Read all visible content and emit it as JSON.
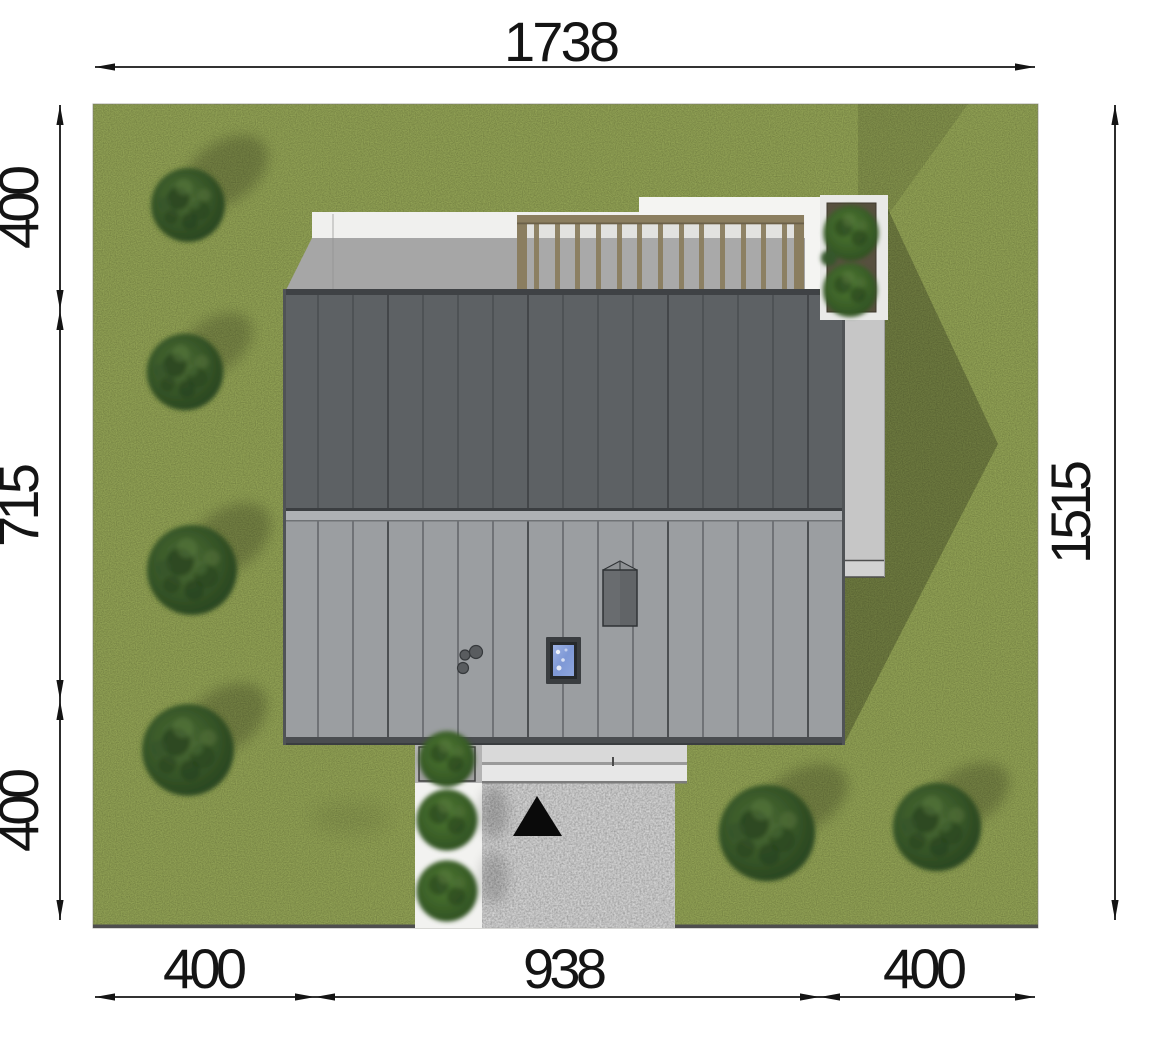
{
  "document": {
    "type": "architectural-site-plan-top-view",
    "units": "centimeters"
  },
  "dimension_labels": {
    "top_total": "1738",
    "right_total": "1515",
    "left": [
      "400",
      "715",
      "400"
    ],
    "bottom": [
      "400",
      "938",
      "400"
    ]
  },
  "icons": {
    "entrance_marker": "filled-triangle-up"
  },
  "colors": {
    "grass": "#85944d",
    "roof_upper": "#5d6164",
    "roof_lower": "#9b9ea1",
    "ridge_cap": "#aeb1b4",
    "terrace_white": "#f0f0ee",
    "terrace_shadow": "#a6a6a6",
    "pergola_wood": "#8b7e60",
    "planter_soil": "#57503f",
    "wall_strip": "#c6c6c6",
    "porch_light": "#d9d9d9",
    "driveway": "#bcbcbc",
    "walkway": "#f2f2f0",
    "dimension_line": "#141414"
  }
}
